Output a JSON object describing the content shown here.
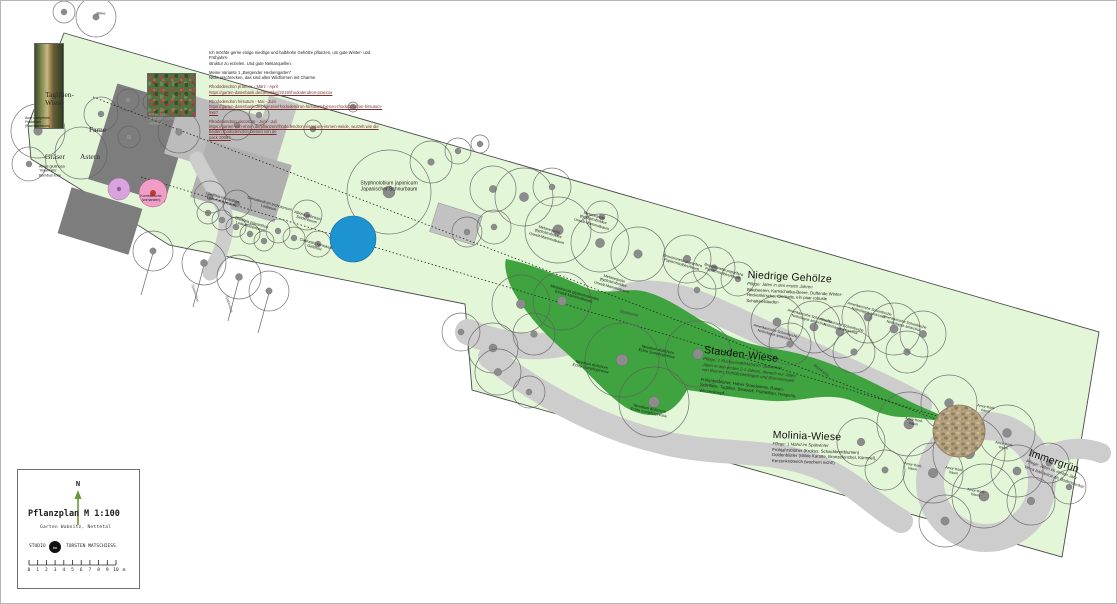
{
  "title_block": {
    "north_label": "N",
    "title": "Pflanzplan",
    "scale": "M 1:100",
    "subtitle": "Garten Wabnitz, Nettetal",
    "studio_prefix": "STUDIO",
    "studio_logo": "tm",
    "studio_name": "TORSTEN MATSCHIESS",
    "scale_numbers": [
      "0",
      "1",
      "2",
      "3",
      "4",
      "5",
      "6",
      "7",
      "8",
      "9",
      "10"
    ],
    "scale_unit": "m"
  },
  "notes": {
    "paragraphs": [
      {
        "color": "#1a1a1a",
        "lines": [
          "Ich möchte gerne einige niedrige und halbhohe Gehölze pflanzen, um gute Winter- und Frühjahrs-",
          "struktur zu erzielen. Und gute Nektarquellen."
        ]
      },
      {
        "color": "#1a1a1a",
        "lines": [
          "Meine Variante 1 „Bergender Heckengarten“",
          "Nicht erschrecken, das sind alles Wildformen mit Charme"
        ]
      },
      {
        "color": "#7a2e2e",
        "lines": [
          "Rhododendron praecox - März - April",
          "https://garten-datenbank.de/de/artikel/2019/rhododendron-praecox"
        ]
      },
      {
        "color": "#7a2e2e",
        "lines": [
          "Rhododendron hirsutum - Mai - Juni",
          "https://garten-datenbank.de/pflanzen/rhododendron-hirsutum-bienen-rhododendron-hirsutum-9x6?"
        ]
      },
      {
        "color": "#7a2e2e",
        "lines": [
          "Rhododendron viscosum - Juni - Juli",
          "https://garten-von-ehren.de/pflanzen/rhododendron-viscosum-immen-weide, wurzelt wie die beiden rhododendron-bienen von de",
          "pack 2008?"
        ]
      }
    ]
  },
  "zone_labels": [
    {
      "x": 44,
      "y": 90,
      "lines": [
        "Taglilien-",
        "Wiese"
      ]
    },
    {
      "x": 88,
      "y": 125,
      "lines": [
        "Farne"
      ]
    },
    {
      "x": 44,
      "y": 152,
      "lines": [
        "Gräser"
      ]
    },
    {
      "x": 79,
      "y": 152,
      "lines": [
        "Astern"
      ]
    }
  ],
  "areas": [
    {
      "x": 747,
      "y": 268,
      "rot": 3,
      "heading": "Niedrige Gehölze",
      "body": [
        {
          "t": "Pflege: Jäten in den ersten Jahren",
          "i": true
        },
        {
          "t": "Blaubeeren, Kamschatka-Beere, Duftende Winter-"
        },
        {
          "t": "Heckenkirsche, Clematis, ein paar robuste"
        },
        {
          "t": "Schattenstauden"
        }
      ]
    },
    {
      "x": 704,
      "y": 343,
      "rot": 7,
      "heading": "Stauden-Wiese",
      "body": [
        {
          "t": "Pflege: 1 Rückschnitt/Mahd im Spätwinter",
          "i": true
        },
        {
          "t": "Jäten in den ersten 2-3 Jahren, danach nur Jäten",
          "i": true
        },
        {
          "t": "von Beeren, Gehölzsämlingen und Brennnesseln",
          "i": true
        },
        {
          "t": "Frühjahrsblüher, Hoher Staudenmix, Rasen-",
          "gap": true
        },
        {
          "t": "Schmiele, Taglilien, Beinwell, Prärielilien, Hesperis,"
        },
        {
          "t": "Wiesenknopf, ..."
        }
      ]
    },
    {
      "x": 772,
      "y": 428,
      "rot": 2,
      "heading": "Molinia-Wiese",
      "body": [
        {
          "t": "Pflege: 1 Mahd im Spätwinter",
          "i": true
        },
        {
          "t": "Frühjahrsblüher (Krokus, Schachbrettblumen)"
        },
        {
          "t": "Doldenblütler (Wilde Karotte, Bronzefenchel, Kümmel),"
        },
        {
          "t": "Kerzenknöterich (wuchern nicht!)"
        }
      ]
    },
    {
      "x": 1030,
      "y": 446,
      "rot": 19,
      "heading": "Immergrün",
      "body": [
        {
          "t": "Pflege: Jäten im ersten Jahr",
          "i": true
        },
        {
          "t": "Vinca balcanica als Bodendecker",
          "i": true
        }
      ]
    }
  ],
  "plant_labels": [
    {
      "x": 100,
      "y": 13,
      "rot": 0,
      "size": 4,
      "lines": [
        "Birke"
      ]
    },
    {
      "x": 24,
      "y": 121,
      "rot": 0,
      "size": 3.6,
      "align": "l",
      "lines": [
        "Acer campestre",
        "Feldahorn",
        "(Nachbarbaum)"
      ]
    },
    {
      "x": 38,
      "y": 170,
      "rot": 0,
      "size": 3.8,
      "align": "l",
      "lines": [
        "Alnus glutinosa",
        "'Imperialis'",
        "Bambus-Erle"
      ]
    },
    {
      "x": 148,
      "y": 118,
      "rot": 0,
      "size": 3.8,
      "align": "l",
      "color": "#a7b19c",
      "lines": [
        "Ribes spec.",
        "Fuchsien-Johan-",
        "nisbeere"
      ]
    },
    {
      "x": 221,
      "y": 199,
      "rot": 16,
      "size": 3.8,
      "lines": [
        "Gleditsia triacanthos",
        "Lederhülsenbaum"
      ]
    },
    {
      "x": 250,
      "y": 224,
      "rot": 16,
      "size": 3.8,
      "lines": [
        "Gleditsia triacanthos",
        "Lederhülsenbaum"
      ]
    },
    {
      "x": 268,
      "y": 205,
      "rot": 16,
      "size": 3.8,
      "lines": [
        "Clerodendrum trichotomum",
        "Losbaum"
      ]
    },
    {
      "x": 306,
      "y": 217,
      "rot": 16,
      "size": 3.8,
      "lines": [
        "Albizia julibrissin",
        "Seidenbaum"
      ]
    },
    {
      "x": 314,
      "y": 245,
      "rot": 16,
      "size": 3.8,
      "lines": [
        "Cladrastis kentukea",
        "Gelbholz"
      ]
    },
    {
      "x": 388,
      "y": 186,
      "rot": 0,
      "size": 5,
      "lines": [
        "Styphnolobium japonicum",
        "Japanischer Schnurbaum"
      ]
    },
    {
      "x": 592,
      "y": 219,
      "rot": 16,
      "size": 3.8,
      "lines": [
        "Metasequoia",
        "glyptostroboides",
        "Urwelt-Mammutbaum"
      ]
    },
    {
      "x": 547,
      "y": 233,
      "rot": 16,
      "size": 3.8,
      "lines": [
        "Metasequoia",
        "glyptostroboides",
        "Urwelt-Mammutbaum"
      ]
    },
    {
      "x": 612,
      "y": 282,
      "rot": 16,
      "size": 3.8,
      "lines": [
        "Metasequoia",
        "glyptostroboides",
        "Urwelt-Mammutbaum"
      ]
    },
    {
      "x": 573,
      "y": 294,
      "rot": 16,
      "size": 3.8,
      "lines": [
        "Metasequoia glyptostroboides",
        "(Urwelt-Mammutbaum)"
      ]
    },
    {
      "x": 681,
      "y": 262,
      "rot": 16,
      "size": 3.8,
      "lines": [
        "Broussonetia papyrifera",
        "Papiermaulbeerbaum"
      ]
    },
    {
      "x": 722,
      "y": 271,
      "rot": 16,
      "size": 3.8,
      "lines": [
        "Broussonetia papyrifera",
        "Papiermaulbeerbaum"
      ]
    },
    {
      "x": 774,
      "y": 332,
      "rot": 15,
      "size": 3.6,
      "lines": [
        "Amerikanische Scheinbuche",
        "Nothofagus antarctica"
      ]
    },
    {
      "x": 808,
      "y": 317,
      "rot": 15,
      "size": 3.6,
      "lines": [
        "Amerikanische Scheinbuche",
        "Nothofagus antarctica"
      ]
    },
    {
      "x": 840,
      "y": 326,
      "rot": 15,
      "size": 3.6,
      "lines": [
        "Amerikanische Scheinbuche",
        "Nothofagus antarctica"
      ]
    },
    {
      "x": 868,
      "y": 310,
      "rot": 15,
      "size": 3.6,
      "lines": [
        "Amerikanische Scheinbuche",
        "Nothofagus antarctica"
      ]
    },
    {
      "x": 903,
      "y": 323,
      "rot": 15,
      "size": 3.6,
      "lines": [
        "Amerikanische Scheinbuche",
        "Nothofagus antarctica"
      ]
    },
    {
      "x": 913,
      "y": 421,
      "rot": 10,
      "size": 3.6,
      "lines": [
        "Amur-Kork-",
        "baum"
      ]
    },
    {
      "x": 985,
      "y": 408,
      "rot": 10,
      "size": 3.6,
      "lines": [
        "Amur-Kork-",
        "baum"
      ]
    },
    {
      "x": 1003,
      "y": 445,
      "rot": 10,
      "size": 3.6,
      "lines": [
        "Amur-Kork-",
        "baum"
      ]
    },
    {
      "x": 912,
      "y": 466,
      "rot": 10,
      "size": 3.6,
      "lines": [
        "Amur-Kork-",
        "baum"
      ]
    },
    {
      "x": 953,
      "y": 470,
      "rot": 10,
      "size": 3.6,
      "lines": [
        "Amur-Kork-",
        "baum"
      ]
    },
    {
      "x": 975,
      "y": 492,
      "rot": 10,
      "size": 3.6,
      "lines": [
        "Amur-Kork-",
        "baum"
      ]
    },
    {
      "x": 656,
      "y": 351,
      "rot": 12,
      "size": 3.8,
      "lines": [
        "Taxodium distichum",
        "Echte Sumpfzypresse"
      ]
    },
    {
      "x": 590,
      "y": 366,
      "rot": 12,
      "size": 3.8,
      "lines": [
        "Taxodium distichum",
        "Echte Sumpfzypresse"
      ]
    },
    {
      "x": 648,
      "y": 410,
      "rot": 12,
      "size": 3.8,
      "lines": [
        "Taxodium distichum",
        "Echte Sumpfzypresse"
      ]
    },
    {
      "x": 820,
      "y": 370,
      "rot": 38,
      "size": 4.2,
      "italic": true,
      "color": "#444444",
      "lines": [
        "Beetkante"
      ]
    },
    {
      "x": 628,
      "y": 313,
      "rot": 14,
      "size": 4.2,
      "italic": true,
      "color": "#444444",
      "lines": [
        "Beetkante"
      ]
    },
    {
      "x": 150,
      "y": 197,
      "rot": 0,
      "size": 3.5,
      "lines": [
        "Kornelkirsche",
        "(vorhanden)"
      ]
    },
    {
      "x": 194,
      "y": 292,
      "rot": 73,
      "size": 3.6,
      "color": "#555555",
      "lines": [
        "Spalierobst"
      ]
    },
    {
      "x": 228,
      "y": 303,
      "rot": 73,
      "size": 3.6,
      "color": "#555555",
      "lines": [
        "Spalierobst"
      ]
    }
  ],
  "colors": {
    "plot_green": "#e3f6d8",
    "meadow_green": "#3fa33f",
    "path_gray": "#cdcdcd",
    "water_blue": "#1d93d2",
    "building_dark": "#7d7d7d",
    "building_light": "#bcbcbc",
    "stone_tan": "#b3a07f",
    "accent_pink": "#f19ec6",
    "accent_purple": "#d9a3dd",
    "north_arrow_green": "#6b9a32",
    "link_red": "#7a2e2e"
  }
}
